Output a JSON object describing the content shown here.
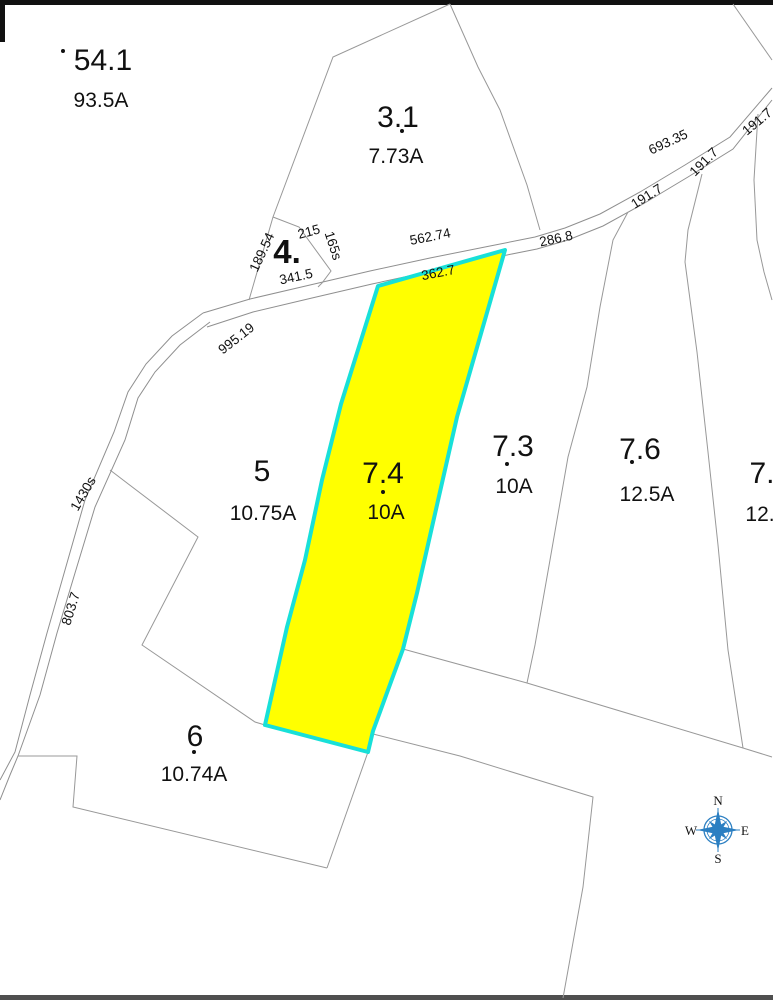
{
  "map_type": "tax-parcel-map",
  "colors": {
    "highlight_fill": "#ffff00",
    "highlight_stroke": "#18e0d8",
    "boundary_line": "#989898",
    "compass_blue": "#2b7fc2",
    "text": "#111111"
  },
  "parcels": [
    {
      "id": "54.1",
      "acreage": "93.5A"
    },
    {
      "id": "3.1",
      "acreage": "7.73A"
    },
    {
      "id": "4.",
      "acreage": ""
    },
    {
      "id": "5",
      "acreage": "10.75A"
    },
    {
      "id": "7.4",
      "acreage": "10A",
      "highlighted": true
    },
    {
      "id": "7.3",
      "acreage": "10A"
    },
    {
      "id": "7.6",
      "acreage": "12.5A"
    },
    {
      "id": "7.",
      "acreage": "12."
    },
    {
      "id": "6",
      "acreage": "10.74A"
    }
  ],
  "dimensions": [
    {
      "text": "189.54"
    },
    {
      "text": "215"
    },
    {
      "text": "165s"
    },
    {
      "text": "341.5"
    },
    {
      "text": "562.74"
    },
    {
      "text": "286.8"
    },
    {
      "text": "362.7"
    },
    {
      "text": "693.35"
    },
    {
      "text": "191.7"
    },
    {
      "text": "191.7"
    },
    {
      "text": "191.7"
    },
    {
      "text": "995.19"
    },
    {
      "text": "1430s"
    },
    {
      "text": "803.7"
    }
  ],
  "compass": {
    "north": "N",
    "east": "E",
    "south": "S",
    "west": "W"
  }
}
